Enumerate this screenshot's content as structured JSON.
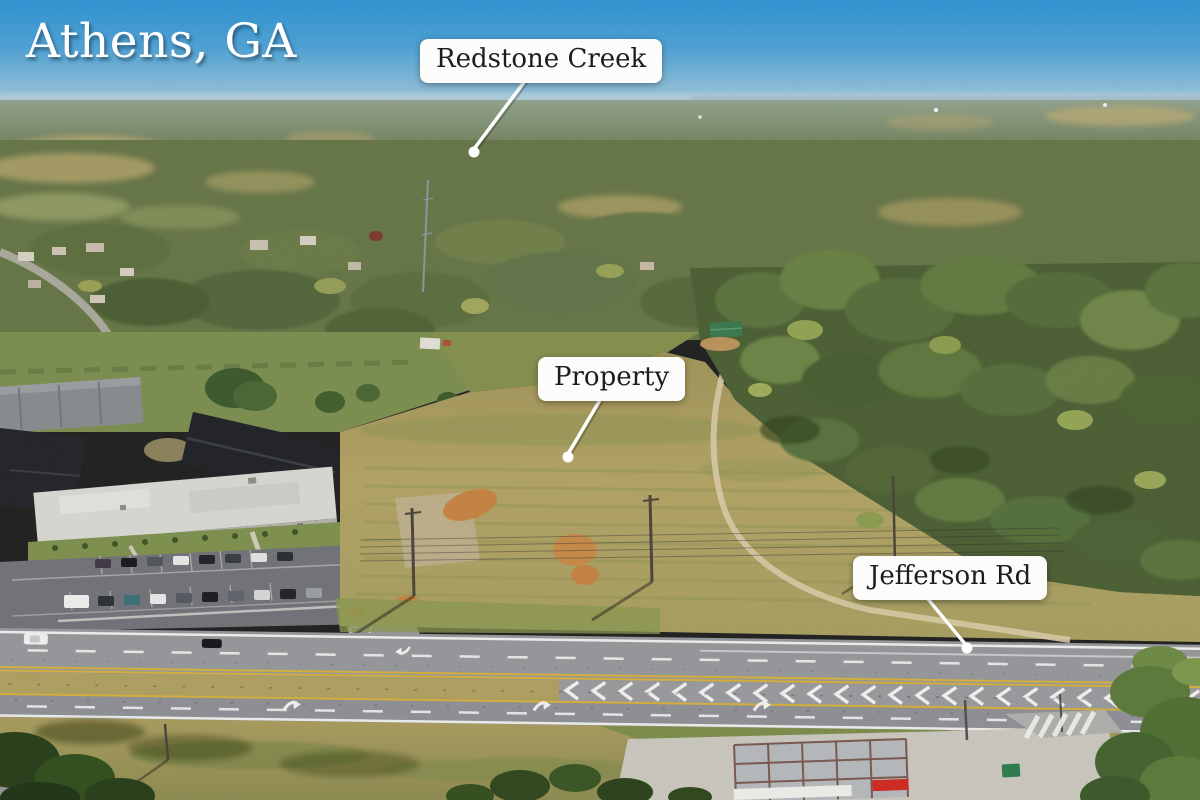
{
  "location_badge": {
    "text": "Athens, GA"
  },
  "callouts": {
    "redstone_creek": {
      "label": "Redstone Creek"
    },
    "property": {
      "label": "Property"
    },
    "jefferson_rd": {
      "label": "Jefferson Rd"
    }
  },
  "palette": {
    "title-text": "#ffffff",
    "label-bg": "#fcfcfa",
    "label-text": "#1d1d1b",
    "leader-line": "#ffffff",
    "sky-top": "#2f94d3",
    "sky-horizon": "#aecbdc",
    "field-tan": "#b0a164",
    "forest-green": "#55683a",
    "road-gray": "#97989c",
    "clay-orange": "#c8813f"
  }
}
